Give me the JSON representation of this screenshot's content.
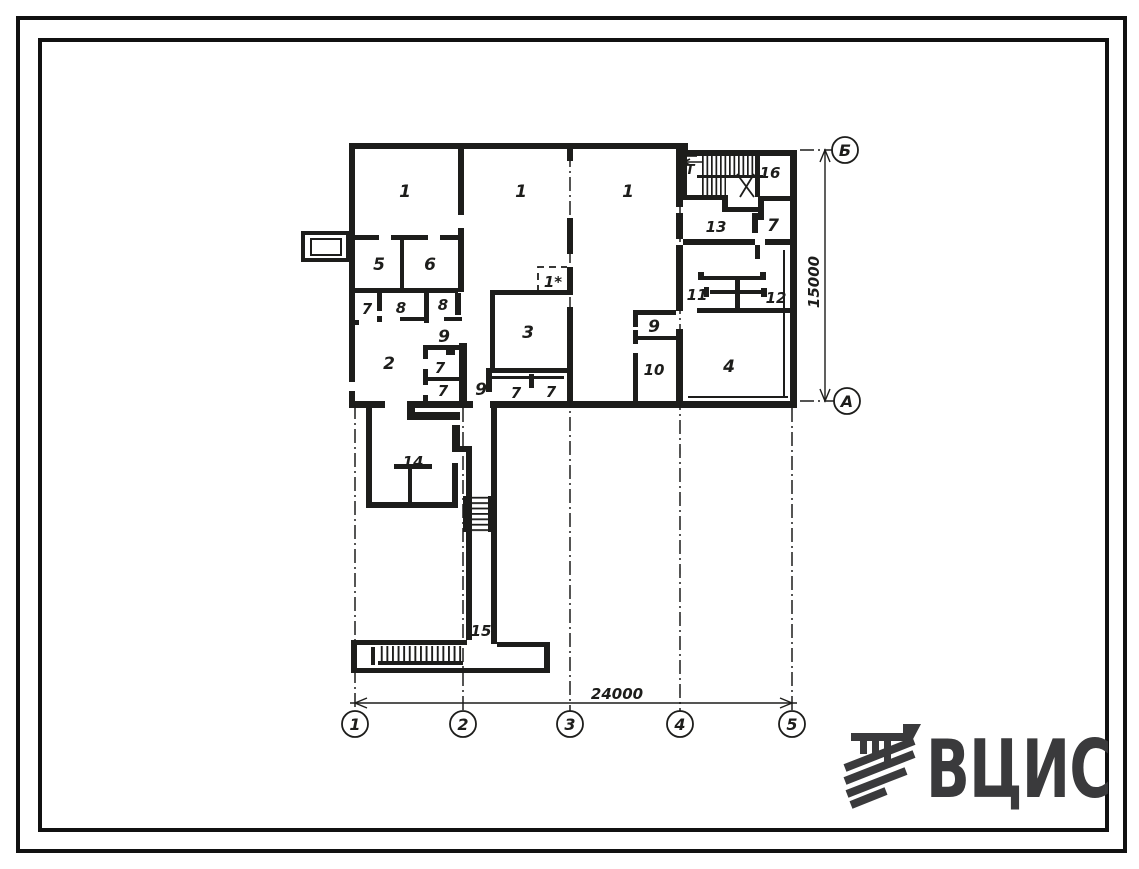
{
  "colors": {
    "ink": "#1d1d1b",
    "logo": "#3a3a3c",
    "paper": "#ffffff"
  },
  "plan": {
    "room_labels": [
      {
        "text": "1"
      },
      {
        "text": "1"
      },
      {
        "text": "1"
      },
      {
        "text": "16"
      },
      {
        "text": "13"
      },
      {
        "text": "7"
      },
      {
        "text": "5"
      },
      {
        "text": "6"
      },
      {
        "text": "7"
      },
      {
        "text": "8"
      },
      {
        "text": "8"
      },
      {
        "text": "9"
      },
      {
        "text": "1*"
      },
      {
        "text": "3"
      },
      {
        "text": "11"
      },
      {
        "text": "12"
      },
      {
        "text": "9"
      },
      {
        "text": "2"
      },
      {
        "text": "7"
      },
      {
        "text": "7"
      },
      {
        "text": "9"
      },
      {
        "text": "7"
      },
      {
        "text": "7"
      },
      {
        "text": "10"
      },
      {
        "text": "4"
      },
      {
        "text": "14"
      },
      {
        "text": "15"
      }
    ],
    "entry_label": "Т",
    "axes": {
      "bottom": [
        "1",
        "2",
        "3",
        "4",
        "5"
      ],
      "right": [
        "Б",
        "А"
      ]
    },
    "dimensions": {
      "horizontal": "24000",
      "vertical": "15000"
    }
  },
  "logo": {
    "text": "ВЦИС"
  }
}
